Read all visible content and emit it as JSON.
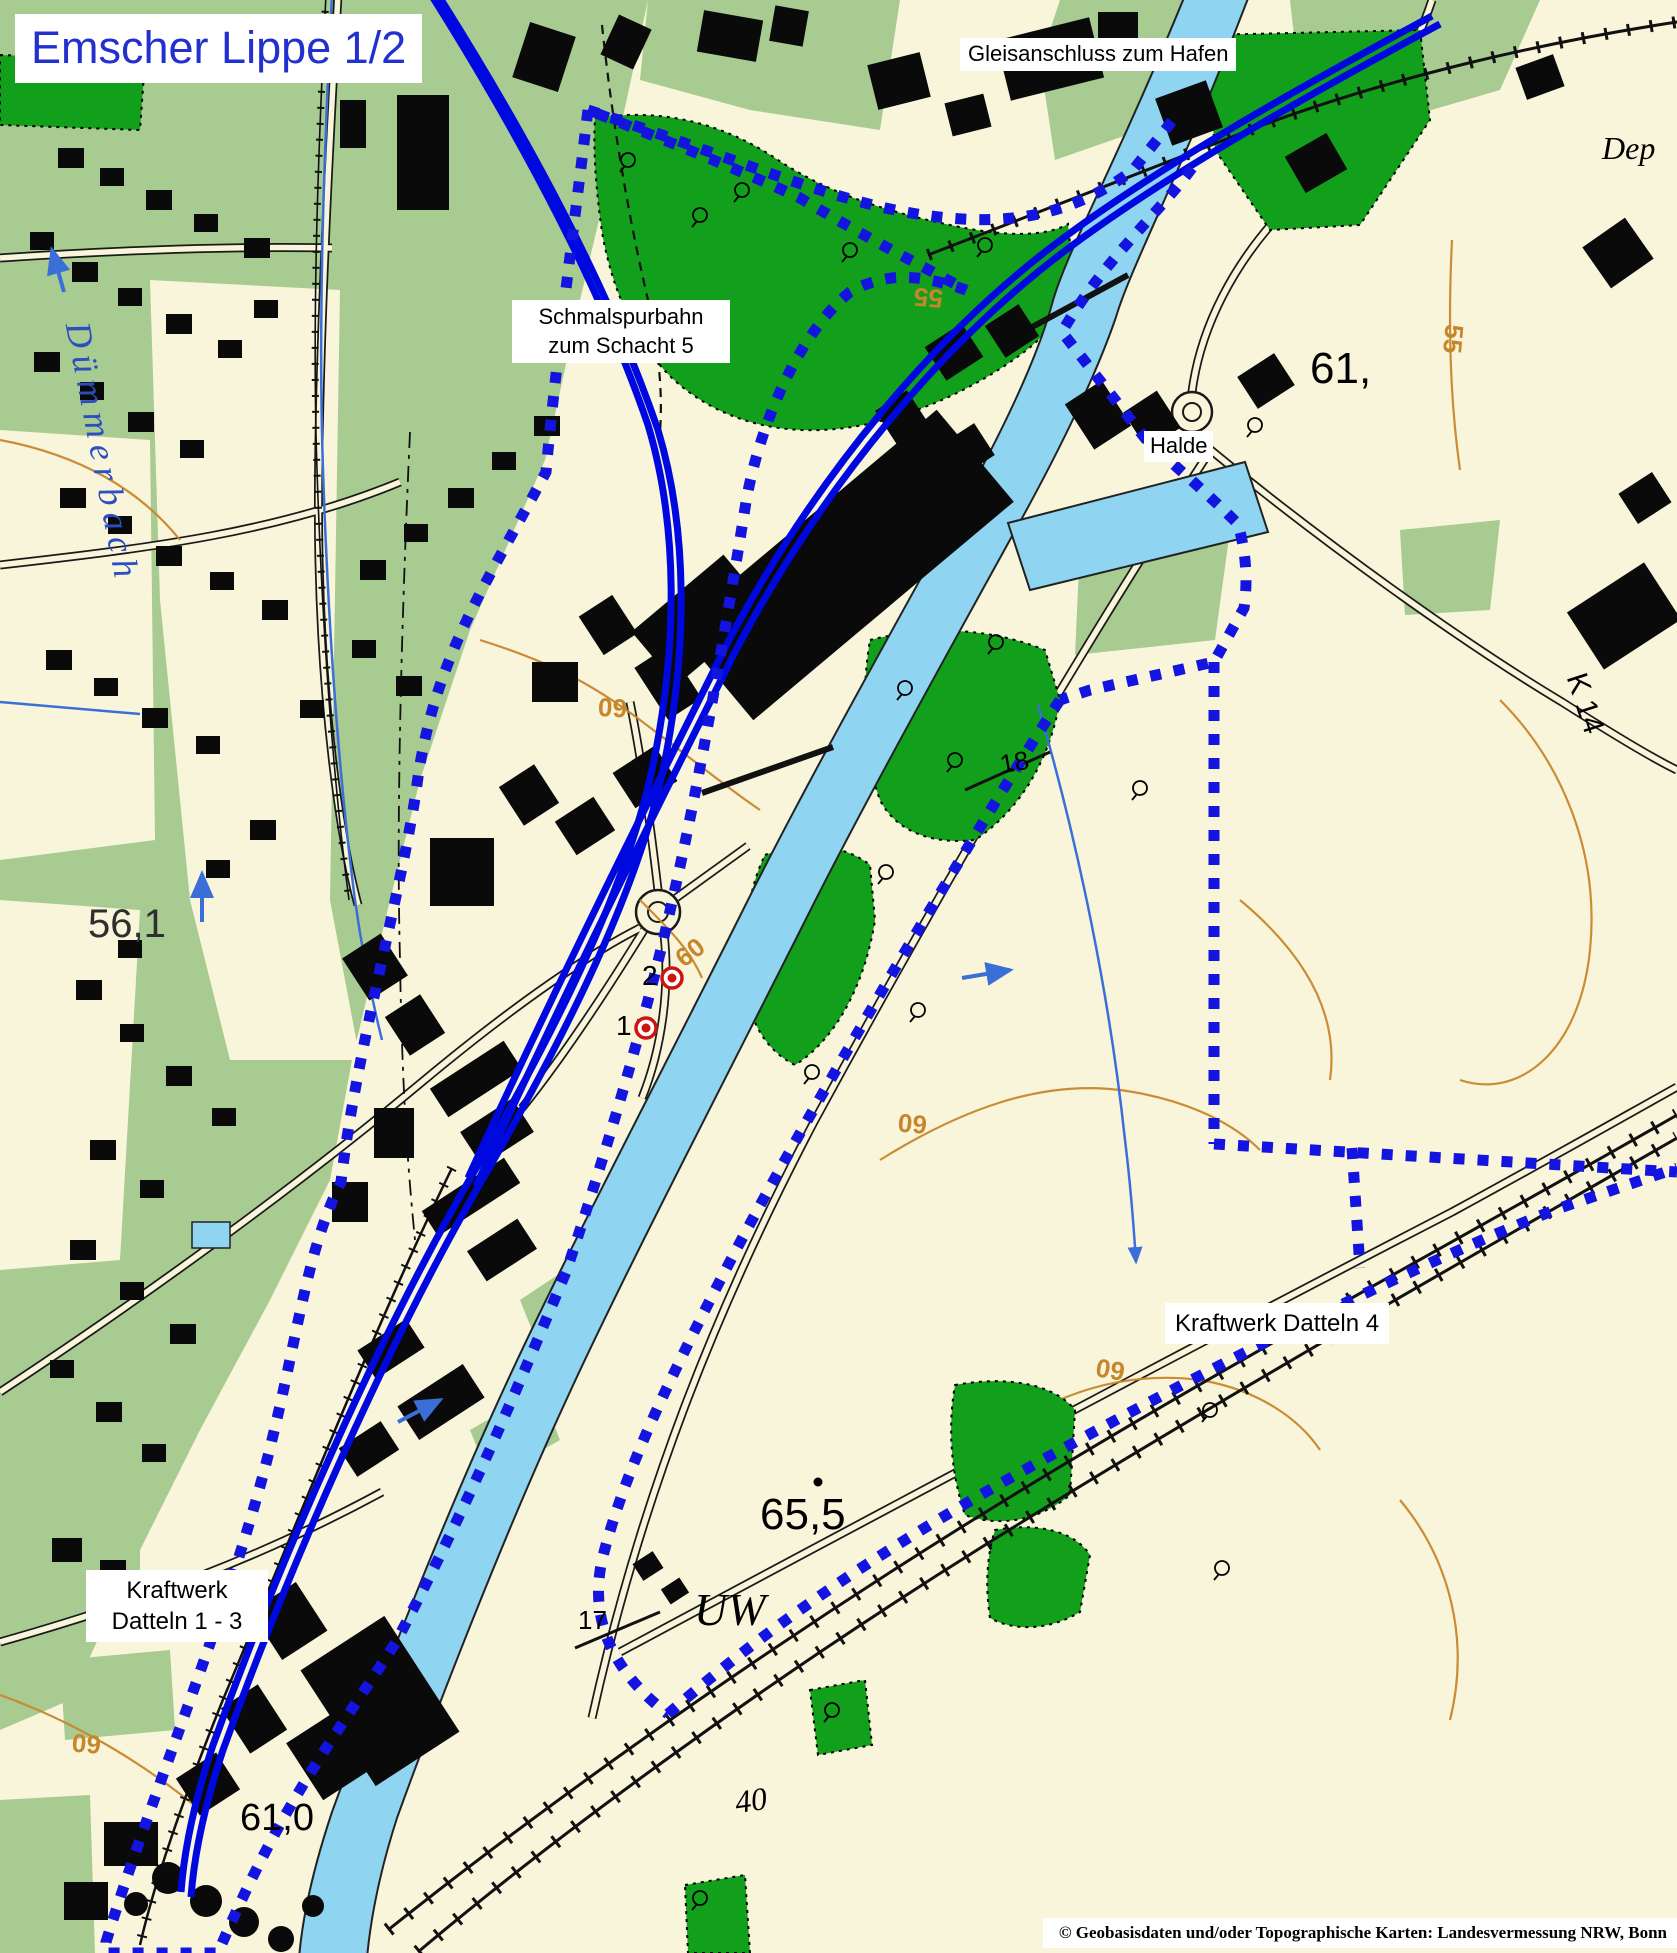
{
  "map": {
    "title": "Emscher Lippe 1/2",
    "copyright": "© Geobasisdaten und/oder Topographische Karten: Landesvermessung NRW, Bonn",
    "labels": {
      "gleisanschluss": "Gleisanschluss zum Hafen",
      "schmalspurbahn": [
        "Schmalspurbahn",
        "zum Schacht 5"
      ],
      "halde": "Halde",
      "kraftwerk_datteln_4": "Kraftwerk Datteln 4",
      "kraftwerk_datteln_1_3": [
        "Kraftwerk",
        "Datteln 1 - 3"
      ],
      "umspannwerk": "UW",
      "stream_name": "Dümmerbach",
      "deponie_partial": "Dep",
      "road_k14": "K 14"
    },
    "elevation_points": {
      "spot_56_1": "56,1",
      "spot_65_5": "65,5",
      "spot_61_canal": "61,",
      "spot_61_0": "61,0"
    },
    "contour_labels": {
      "c55": "55",
      "c60": "60"
    },
    "waypoint_numbers": {
      "km17": "17",
      "km18": "18",
      "n40": "40"
    },
    "site_markers": [
      {
        "number": "1"
      },
      {
        "number": "2"
      }
    ],
    "colors": {
      "title_blue": "#2230cf",
      "route_blue": "#0008e0",
      "boundary_blue": "#1414e0",
      "canal_blue": "#8fd5f1",
      "residential_green": "#a7cb90",
      "forest_green": "#12a01c",
      "background_cream": "#f8f5da",
      "contour_orange": "#c8862c",
      "marker_red": "#cc1511",
      "stream_blue": "#3a6fd8"
    }
  }
}
